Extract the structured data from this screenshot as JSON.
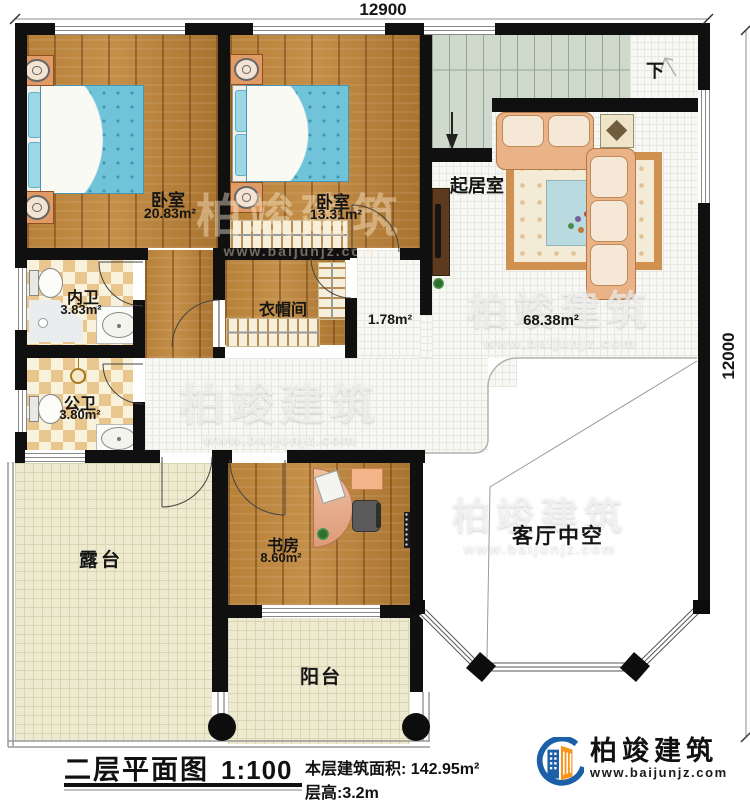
{
  "dimensions": {
    "top": "12900",
    "right": "12000"
  },
  "rooms": {
    "bedroom1": {
      "name": "卧室",
      "area": "20.83m²"
    },
    "bedroom2": {
      "name": "卧室",
      "area": "13.31m²"
    },
    "bath_inner": {
      "name": "内卫",
      "area": "3.83m²"
    },
    "bath_public": {
      "name": "公卫",
      "area": "3.80m²"
    },
    "closet": {
      "name": "衣帽间"
    },
    "corridor": {
      "area": "1.78m²"
    },
    "living": {
      "name": "起居室",
      "area": "68.38m²"
    },
    "terrace": {
      "name": "露台"
    },
    "study": {
      "name": "书房",
      "area": "8.60m²"
    },
    "balcony": {
      "name": "阳台"
    },
    "void": {
      "name": "客厅中空"
    },
    "stairs": {
      "down_label": "下"
    }
  },
  "footer": {
    "title": "二层平面图",
    "scale": "1:100",
    "area_label": "本层建筑面积:",
    "area_value": "142.95m²",
    "height_label": "层高:3.2m"
  },
  "logo": {
    "name": "柏竣建筑",
    "url": "www.baijunjz.com"
  },
  "watermark": {
    "text": "柏竣建筑",
    "url": "www.baijunjz.com"
  },
  "colors": {
    "wall": "#101010",
    "wood_floor": "#b8813a",
    "bed": "#71c3d9",
    "tile_cream": "#edead0",
    "tile_checker": "#e9c68e",
    "stairs": "#cfdacd",
    "sofa": "#e9b287",
    "logo_blue": "#1a5fa8",
    "logo_orange": "#f7941d"
  }
}
